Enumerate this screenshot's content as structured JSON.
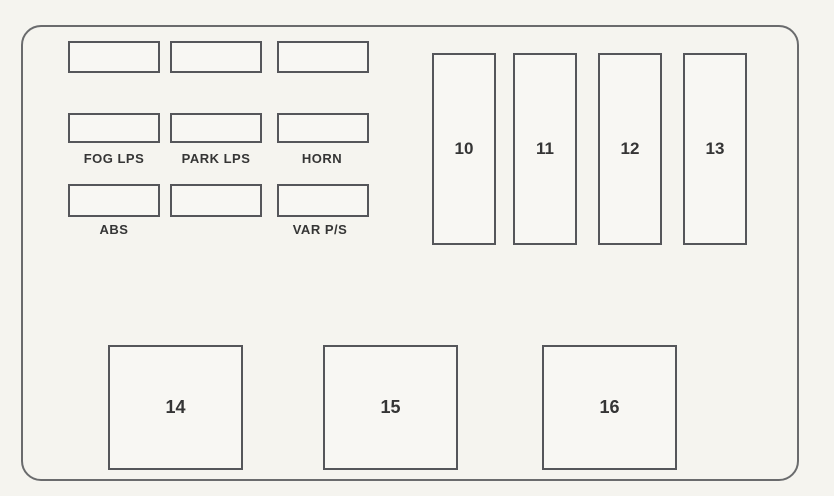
{
  "colors": {
    "background": "#f5f4ef",
    "panel_line": "#6a6b6d",
    "fuse_line": "#55565a",
    "text": "#353535"
  },
  "small_fuses": {
    "rows": [
      {
        "cells": [
          {
            "label": ""
          },
          {
            "label": ""
          },
          {
            "label": ""
          }
        ]
      },
      {
        "cells": [
          {
            "label": "FOG LPS"
          },
          {
            "label": "PARK LPS"
          },
          {
            "label": "HORN"
          }
        ]
      },
      {
        "cells": [
          {
            "label": "ABS"
          },
          {
            "label": ""
          },
          {
            "label": "VAR P/S"
          }
        ]
      }
    ]
  },
  "relays": [
    {
      "label": "10"
    },
    {
      "label": "11"
    },
    {
      "label": "12"
    },
    {
      "label": "13"
    }
  ],
  "large_fuses": [
    {
      "label": "14"
    },
    {
      "label": "15"
    },
    {
      "label": "16"
    }
  ]
}
